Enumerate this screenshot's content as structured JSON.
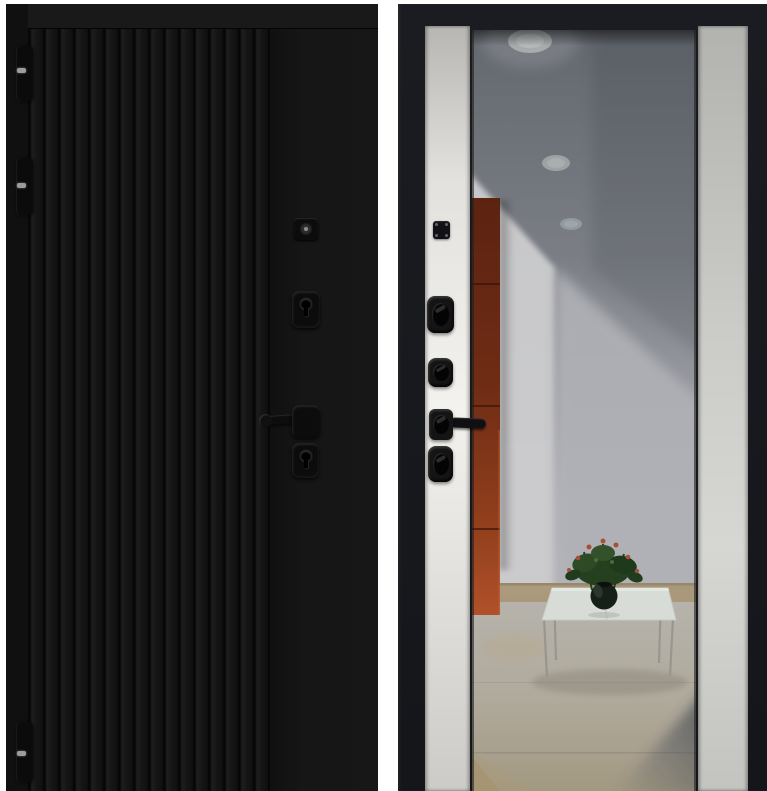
{
  "image": {
    "subject": "Steel entry door product photo — exterior and interior sides",
    "background_color": "#ffffff"
  },
  "colors": {
    "bg_white": "#ffffff",
    "door_black": "#141414",
    "door_groove": "#070707",
    "door_rail": "#191919",
    "frame_dark": "#1a1c21",
    "stile_dark": "#14161a",
    "hardware_black": "#0c0c0c",
    "pin_gray": "#9c9c9c",
    "cabinet_orange": "#8a3c1d",
    "ceiling_gray": "#6e7278",
    "wall_gray": "#c3c3c6",
    "floor_beige": "#b0a896",
    "table_glass": "#d8dcd7",
    "plant_green": "#2a4423",
    "flower_red": "#a84f38",
    "vase_dark": "#161f18"
  },
  "exterior_panel": {
    "label": "Exterior side: black fluted steel panel",
    "flute_count": 16,
    "hinge_count": 3,
    "hardware": {
      "viewer": "door viewer cylinder",
      "upper_lock": "upper deadbolt escutcheon",
      "handle": "lever handle",
      "lower_lock": "lower deadbolt escutcheon"
    }
  },
  "interior_panel": {
    "label": "Interior side: light side panels with full-height mirror",
    "hardware": {
      "plate": "lock mounting plate",
      "thumbturn_upper": "upper thumbturn",
      "thumbturn_middle": "middle thumbturn",
      "handle": "lever handle",
      "thumbturn_lower": "lower thumbturn"
    },
    "mirror_reflection": {
      "spotlight_count": 3,
      "items": [
        "gray ceiling with recessed spotlights",
        "orange-brown cabinet",
        "white walls",
        "glass coffee table",
        "potted plant with red blooms in dark round vase",
        "beige tiled floor"
      ]
    }
  }
}
